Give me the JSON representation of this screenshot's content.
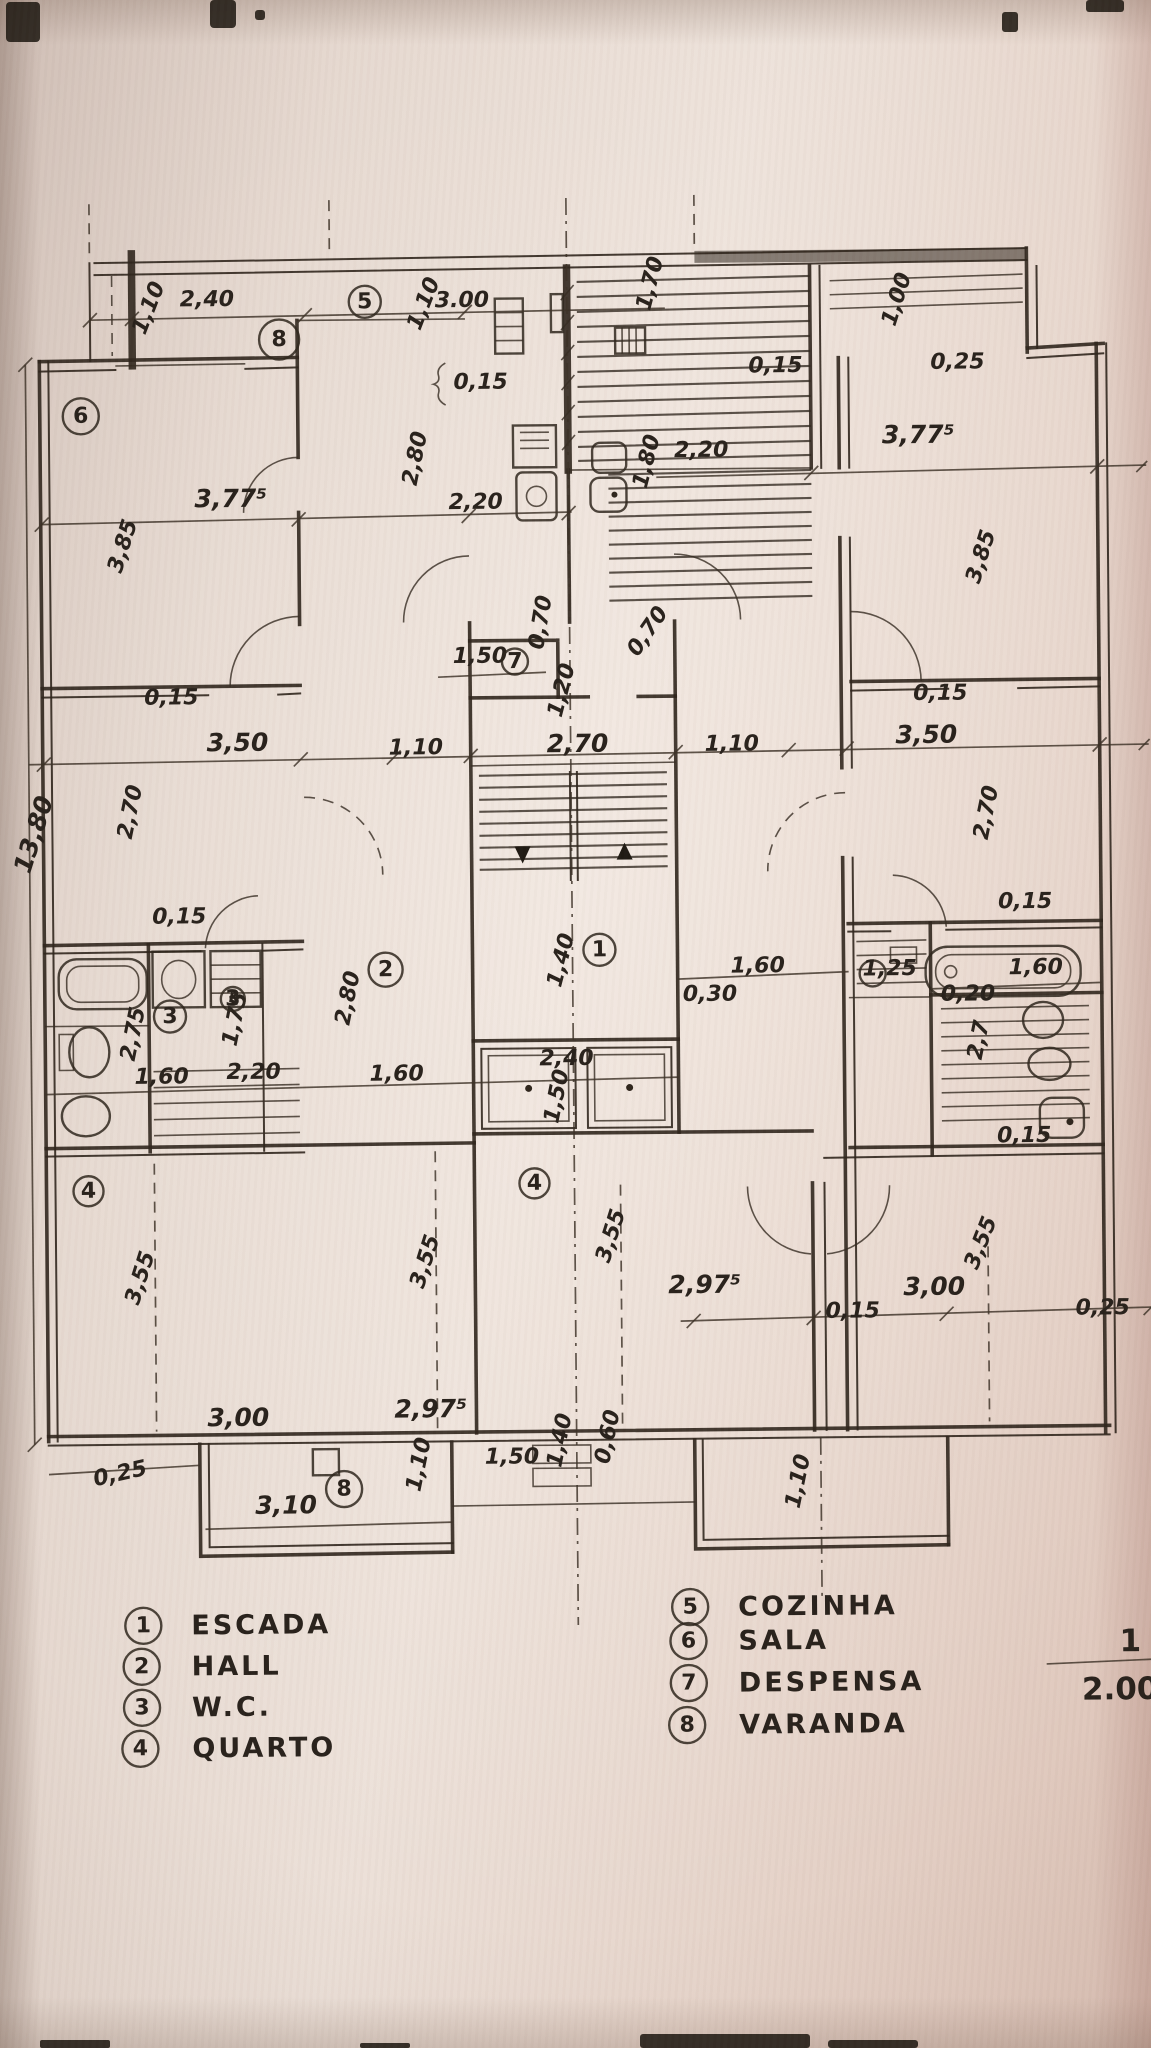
{
  "legend": {
    "left": [
      {
        "num": "1",
        "label": "ESCADA"
      },
      {
        "num": "2",
        "label": "HALL"
      },
      {
        "num": "3",
        "label": "W.C."
      },
      {
        "num": "4",
        "label": "QUARTO"
      }
    ],
    "right": [
      {
        "num": "5",
        "label": "COZINHA"
      },
      {
        "num": "6",
        "label": "SALA"
      },
      {
        "num": "7",
        "label": "DESPENSA"
      },
      {
        "num": "8",
        "label": "VARANDA"
      }
    ]
  },
  "scale": {
    "numerator": "1",
    "denominator": "2.000"
  },
  "markers": {
    "m1": "1",
    "m2": "2",
    "m3a": "3",
    "m3b": "3",
    "m4a": "4",
    "m4b": "4",
    "m5": "5",
    "m6": "6",
    "m7": "7",
    "m8a": "8",
    "m8b": "8"
  },
  "dims": {
    "d01": "2,40",
    "d02": "1,10",
    "d03": "3.00",
    "d04": "1,10",
    "d05": "1,70",
    "d06": "1,00",
    "d07": "0,25",
    "d08": "0,15",
    "d09": "3,77⁵",
    "d10": "2,80",
    "d11": "2,20",
    "d12": "1,80",
    "d13": "2,20",
    "d14": "3,77⁵",
    "d15": "0,15",
    "d16": "3,85",
    "d17": "3,85",
    "d18": "1,50",
    "d19": "0,70",
    "d20": "0,70",
    "d21": "1,20",
    "d22": "2,70",
    "d23": "1,10",
    "d24": "1,10",
    "d25": "3,50",
    "d26": "3,50",
    "d27": "0,15",
    "d28": "0,15",
    "d29": "2,70",
    "d30": "2,70",
    "d31": "0,15",
    "d32": "0,15",
    "d33": "1,40",
    "d34": "1,60",
    "d35": "0,30",
    "d36": "1,25",
    "d37": "1,60",
    "d38": "0,20",
    "d39": "2,7",
    "d40": "0,15",
    "d41": "2,75",
    "d42": "1,75",
    "d43": "1,60",
    "d44": "2,20",
    "d45": "2,80",
    "d46": "1,60",
    "d47": "2,40",
    "d48": "1,50",
    "d49": "3,55",
    "d50": "3,55",
    "d51": "3,55",
    "d52": "3,55",
    "d53": "2,97⁵",
    "d54": "3,00",
    "d55": "0,15",
    "d56": "0,25",
    "d57": "3,00",
    "d58": "2,97⁵",
    "d59": "0,25",
    "d60": "1,10",
    "d61": "1,50",
    "d62": "1,40",
    "d63": "0,60",
    "d64": "3,10",
    "d65": "1,10",
    "d66": "13,80"
  }
}
